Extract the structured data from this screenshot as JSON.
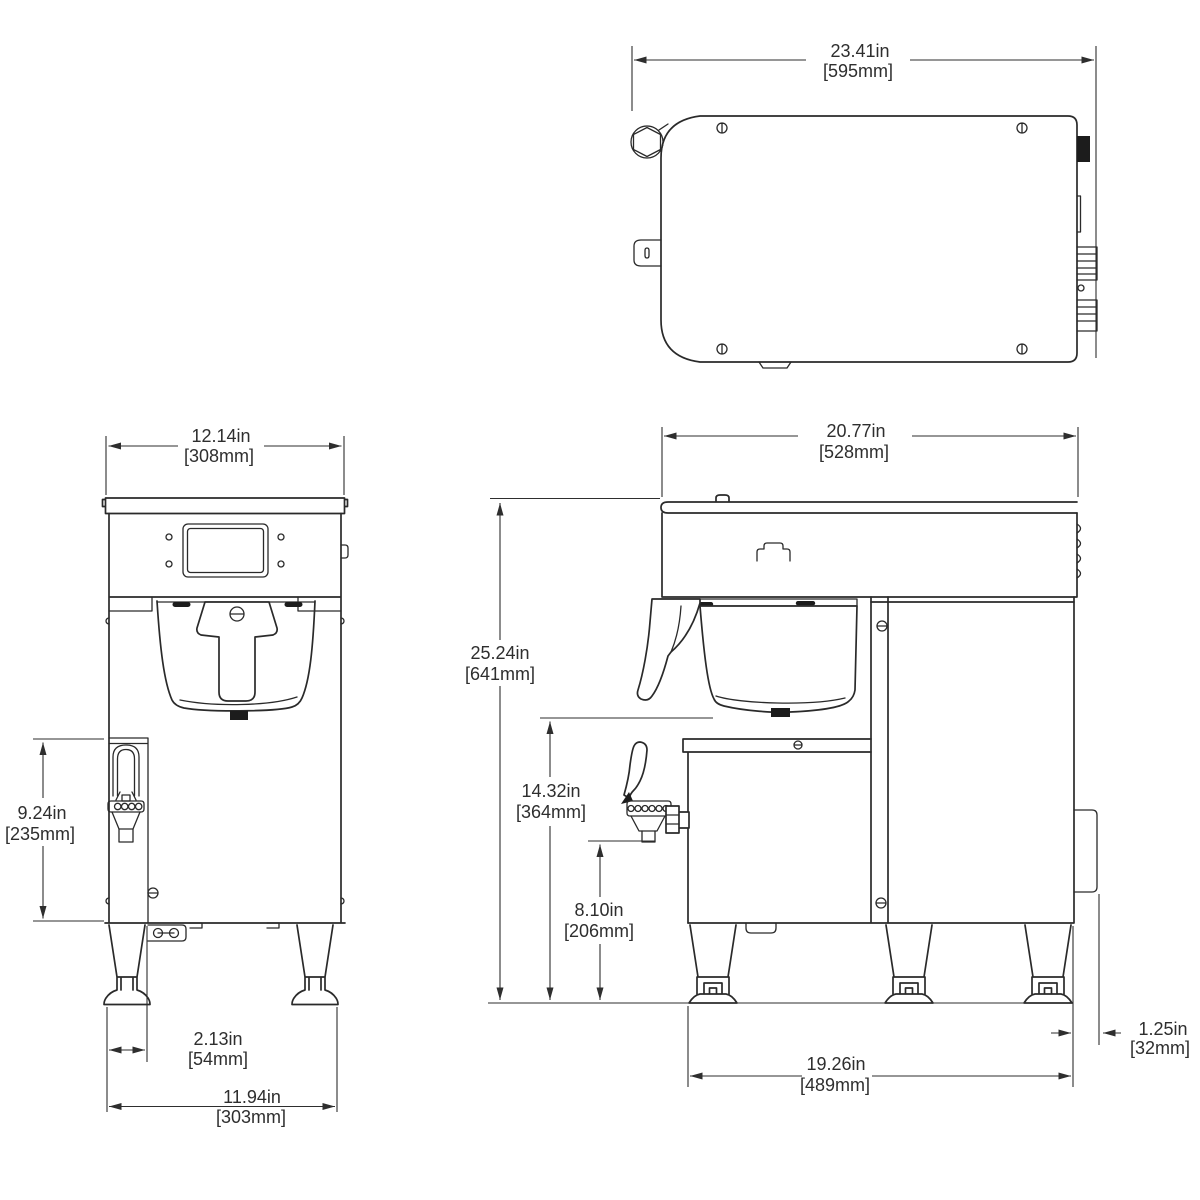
{
  "colors": {
    "ink": "#2a2a2a",
    "background": "#ffffff"
  },
  "dimensions": {
    "top_width": {
      "in": "23.41in",
      "mm": "[595mm]"
    },
    "front_width": {
      "in": "12.14in",
      "mm": "[308mm]"
    },
    "front_faucet_height": {
      "in": "9.24in",
      "mm": "[235mm]"
    },
    "front_faucet_offset": {
      "in": "2.13in",
      "mm": "[54mm]"
    },
    "front_base_width": {
      "in": "11.94in",
      "mm": "[303mm]"
    },
    "side_depth": {
      "in": "20.77in",
      "mm": "[528mm]"
    },
    "side_height": {
      "in": "25.24in",
      "mm": "[641mm]"
    },
    "side_mid_height": {
      "in": "14.32in",
      "mm": "[364mm]"
    },
    "side_spout_height": {
      "in": "8.10in",
      "mm": "[206mm]"
    },
    "side_base_depth": {
      "in": "19.26in",
      "mm": "[489mm]"
    },
    "side_rear_offset": {
      "in": "1.25in",
      "mm": "[32mm]"
    }
  }
}
